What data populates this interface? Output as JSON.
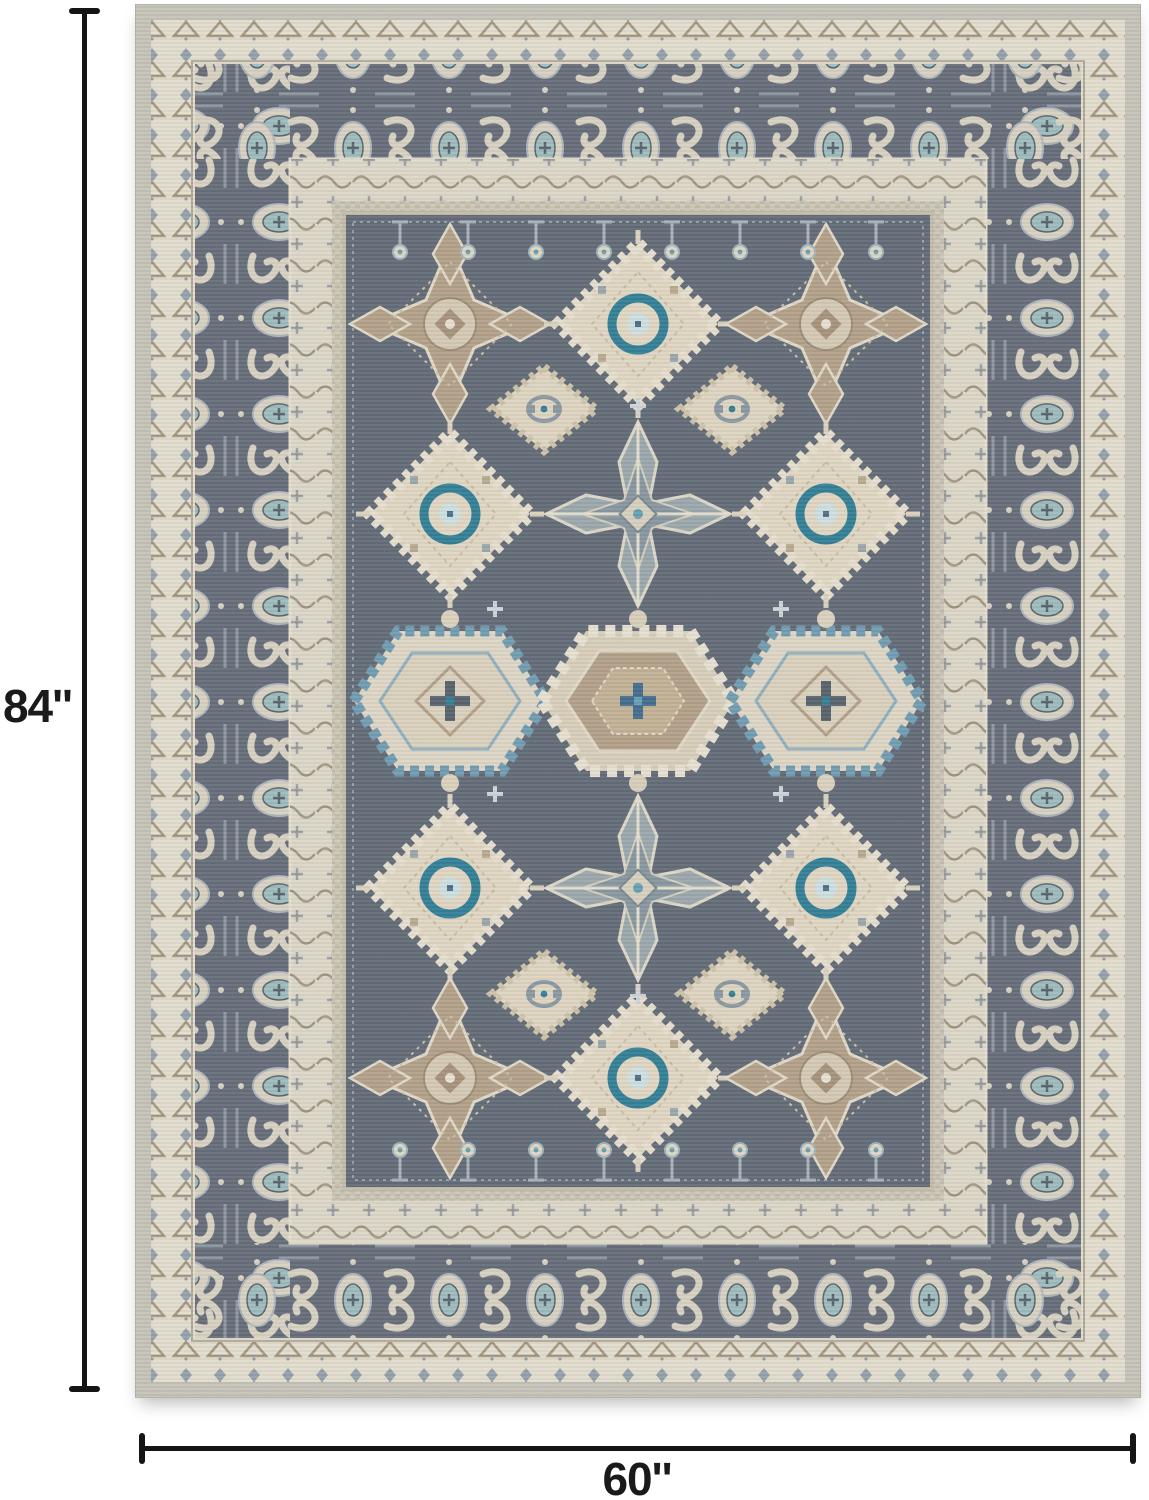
{
  "dimensions": {
    "height_label": "84''",
    "width_label": "60''"
  },
  "palette": {
    "background": "#ffffff",
    "dimension_line": "#151515",
    "label_ink": "#1a1a1a",
    "rug_binding": "#c7c4ba",
    "rug_outer_band": "#e4dfd0",
    "rug_border_slate": "#636b78",
    "rug_border_motif_cream": "#d9d3c3",
    "rug_inner_band": "#ded9c9",
    "rug_field": "#606975",
    "rug_tan": "#b3a088",
    "rug_cream": "#e2d8c4",
    "rug_blue": "#64a0b4",
    "rug_teal": "#2e7e96",
    "rug_slate_light": "#9aa8ac"
  }
}
